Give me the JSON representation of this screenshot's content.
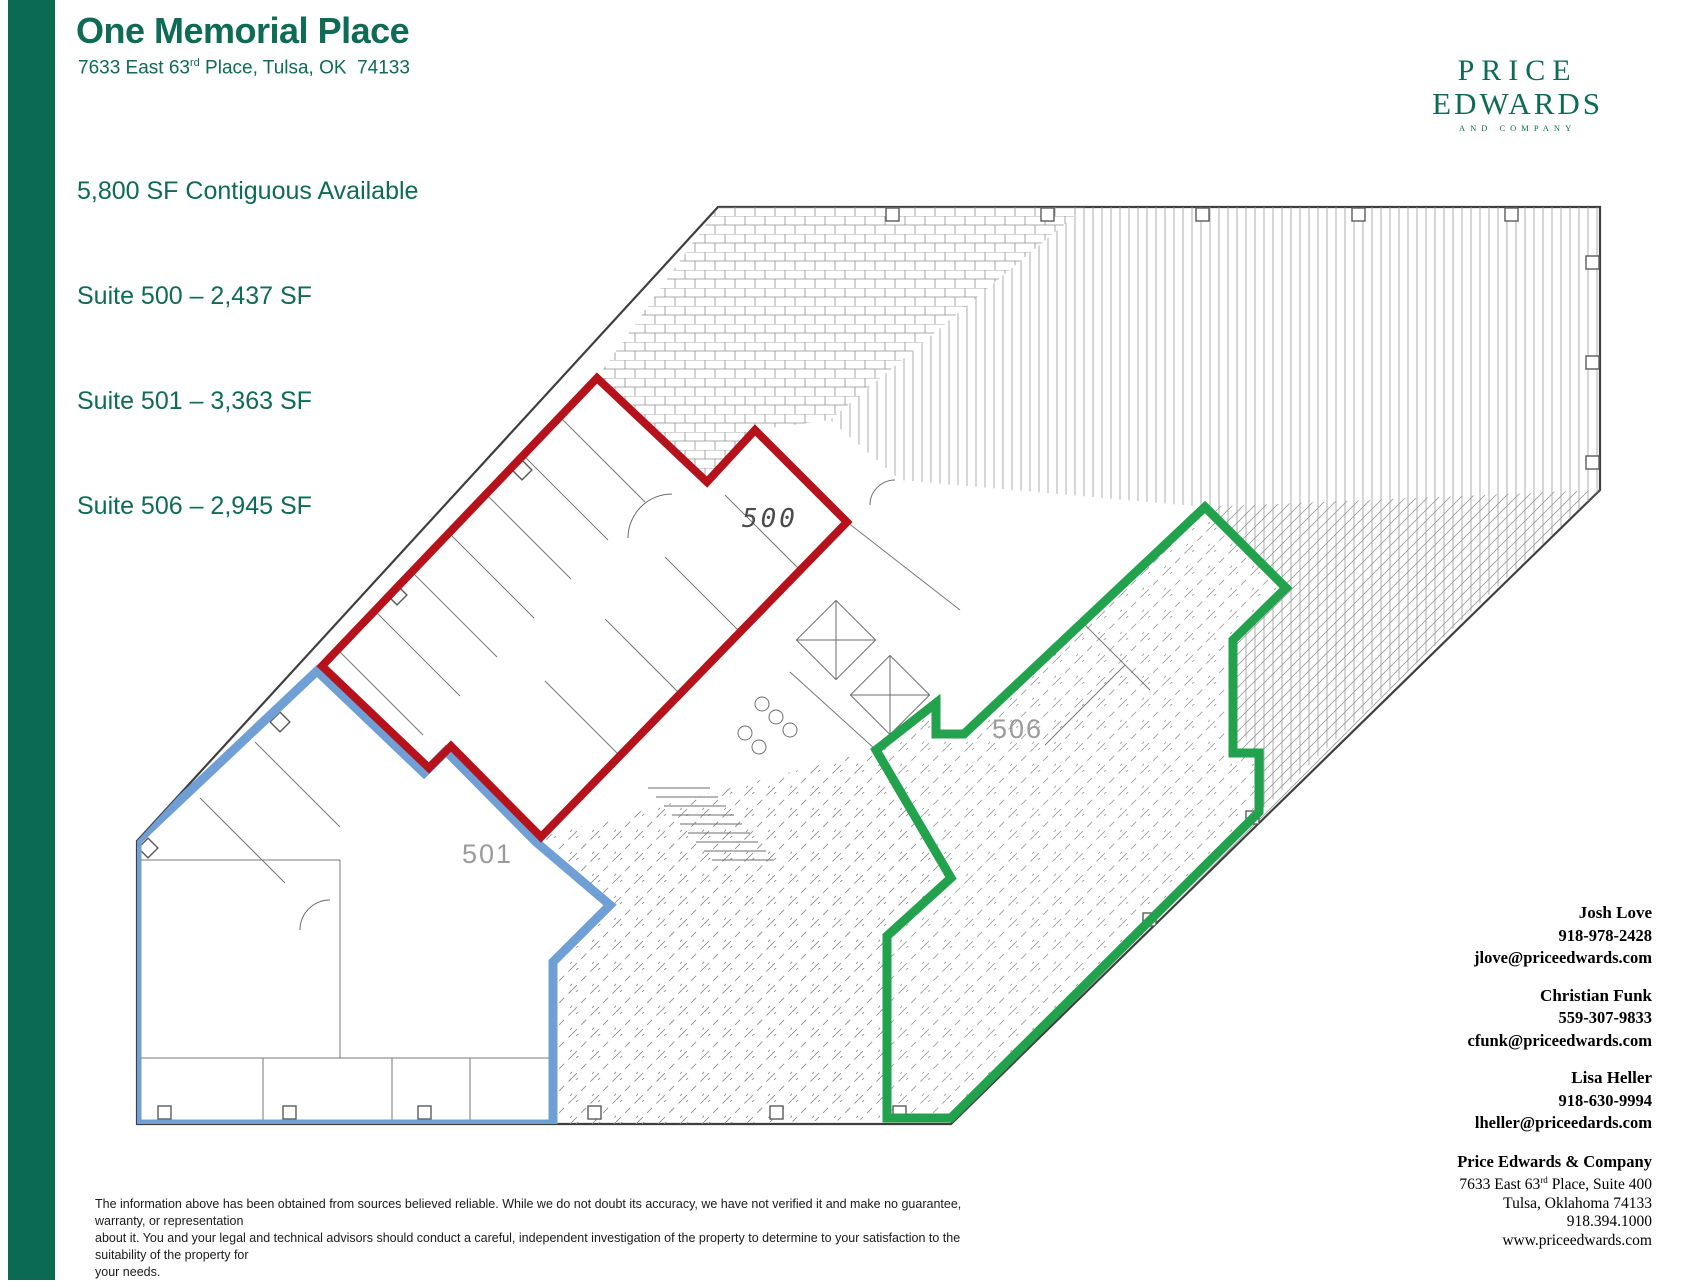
{
  "colors": {
    "brand": "#0e6b55",
    "bar": "#0a6a52",
    "suite_500_outline": "#b5121b",
    "suite_501_outline": "#6f9fd4",
    "suite_506_outline": "#22a24c"
  },
  "header": {
    "title": "One Memorial Place",
    "address_prefix": "7633 East 63",
    "address_sup": "rd",
    "address_suffix": " Place, Tulsa, OK  74133",
    "availability": "5,800 SF Contiguous Available",
    "suites": [
      {
        "label": "Suite 500 – 2,437 SF"
      },
      {
        "label": "Suite 501 – 3,363 SF"
      },
      {
        "label": "Suite 506 – 2,945 SF"
      }
    ]
  },
  "logo": {
    "line1": "PRICE",
    "line2": "EDWARDS",
    "line3": "AND COMPANY"
  },
  "floorplan": {
    "labels": {
      "suite500": "500",
      "suite501": "501",
      "suite506": "506"
    }
  },
  "contacts": [
    {
      "name": "Josh Love",
      "phone": "918-978-2428",
      "email": "jlove@priceedwards.com"
    },
    {
      "name": "Christian Funk",
      "phone": "559-307-9833",
      "email": "cfunk@priceedwards.com"
    },
    {
      "name": "Lisa Heller",
      "phone": "918-630-9994",
      "email": "lheller@priceedards.com"
    }
  ],
  "company": {
    "name": "Price Edwards & Company",
    "address1_prefix": "7633 East 63",
    "address1_sup": "rd",
    "address1_suffix": " Place, Suite 400",
    "address2": "Tulsa, Oklahoma  74133",
    "phone": "918.394.1000",
    "website": "www.priceedwards.com"
  },
  "disclaimer": {
    "line1": "The information above has been obtained from sources believed reliable.  While we do not doubt its accuracy, we have not verified it and make no guarantee, warranty, or representation",
    "line2": "about it.  You and your legal and technical advisors should conduct a careful, independent investigation of the property to determine to your satisfaction to the suitability of the property for",
    "line3": "your needs."
  }
}
